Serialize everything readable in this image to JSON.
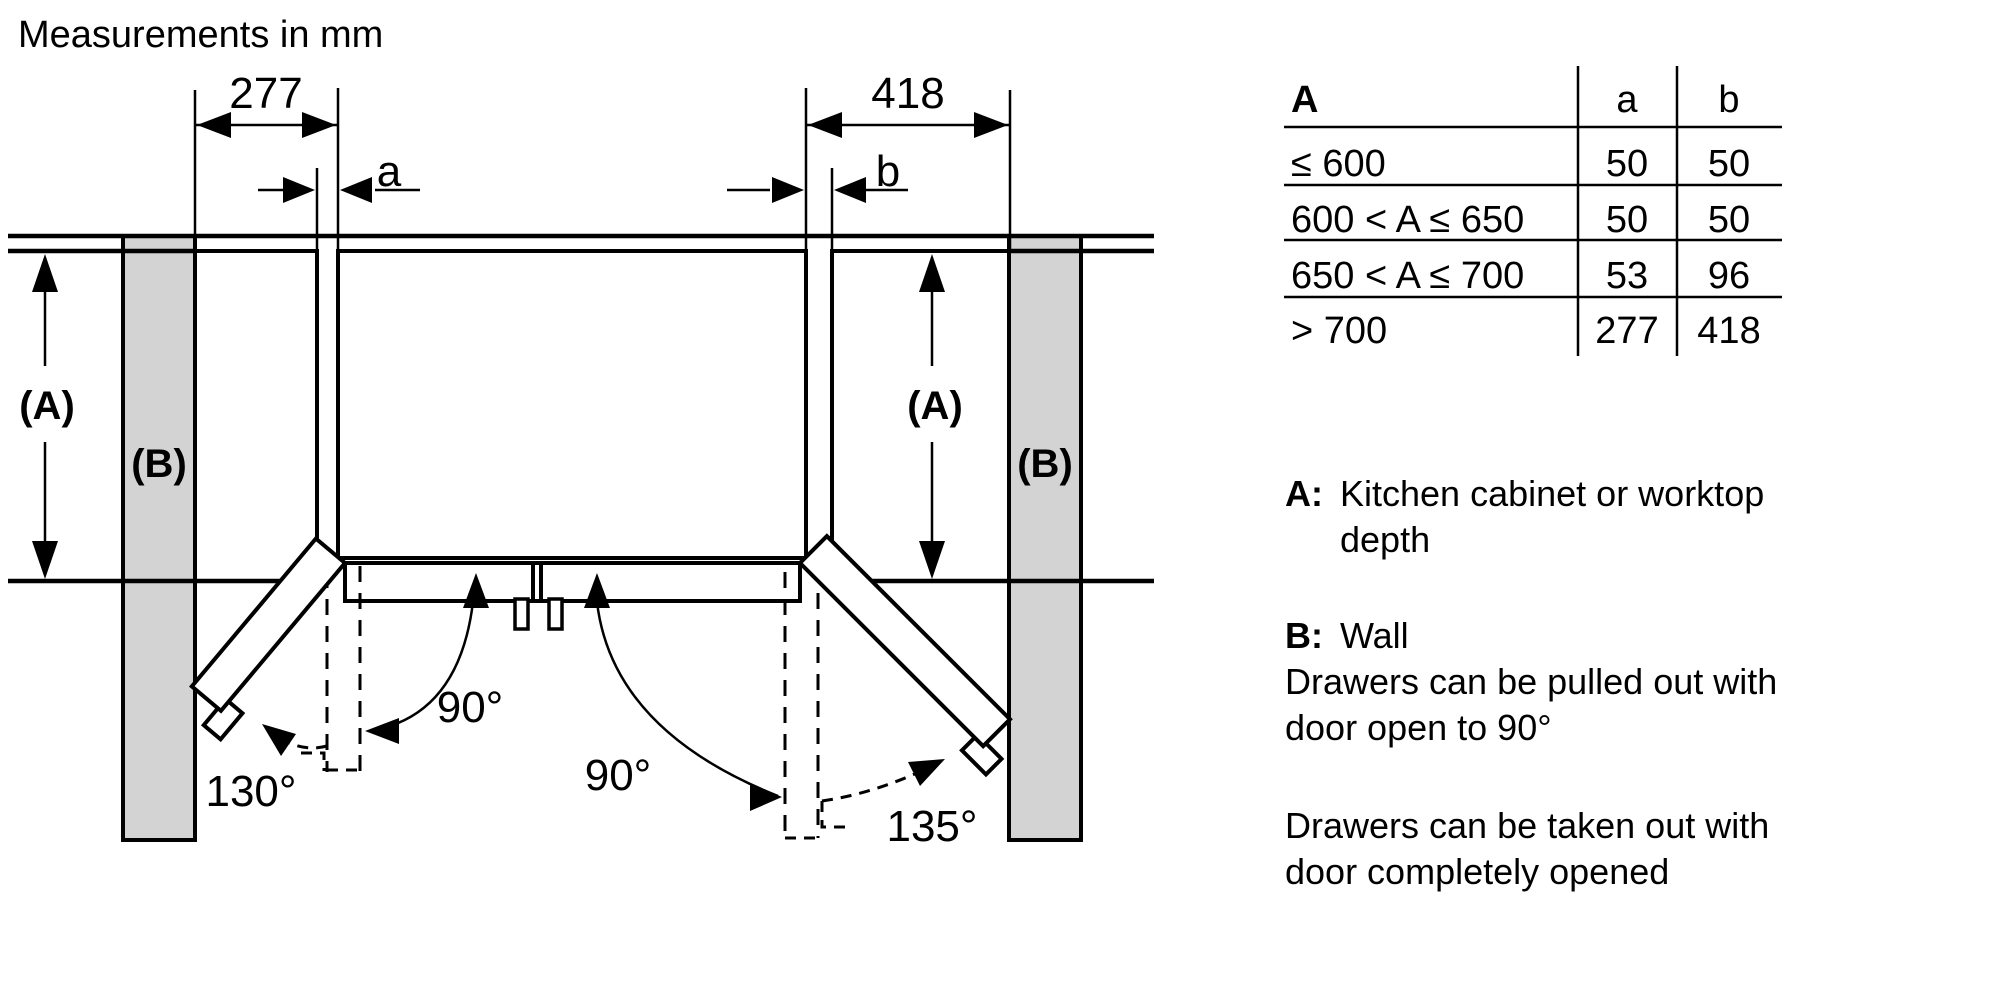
{
  "title": "Measurements in mm",
  "diagram": {
    "dim_left": "277",
    "dim_right": "418",
    "gap_left_label": "a",
    "gap_right_label": "b",
    "depth_label_left": "(A)",
    "depth_label_right": "(A)",
    "wall_label_left": "(B)",
    "wall_label_right": "(B)",
    "angle_left_90": "90°",
    "angle_right_90": "90°",
    "angle_left_max": "130°",
    "angle_right_max": "135°"
  },
  "table": {
    "header": {
      "range": "A",
      "a": "a",
      "b": "b"
    },
    "rows": [
      {
        "range": "≤ 600",
        "a": "50",
        "b": "50"
      },
      {
        "range": "600 < A ≤ 650",
        "a": "50",
        "b": "50"
      },
      {
        "range": "650 < A ≤ 700",
        "a": "53",
        "b": "96"
      },
      {
        "range": "> 700",
        "a": "277",
        "b": "418"
      }
    ]
  },
  "legend": {
    "a_key": "A:",
    "a_text_line1": "Kitchen cabinet or worktop",
    "a_text_line2": "depth",
    "b_key": "B:",
    "b_text": "Wall",
    "note1_line1": "Drawers can be pulled out with",
    "note1_line2": "door open to 90°",
    "note2_line1": "Drawers can be taken out with",
    "note2_line2": "door completely opened"
  },
  "colors": {
    "wall_fill": "#d3d3d3",
    "line": "#000000",
    "background": "#ffffff"
  }
}
